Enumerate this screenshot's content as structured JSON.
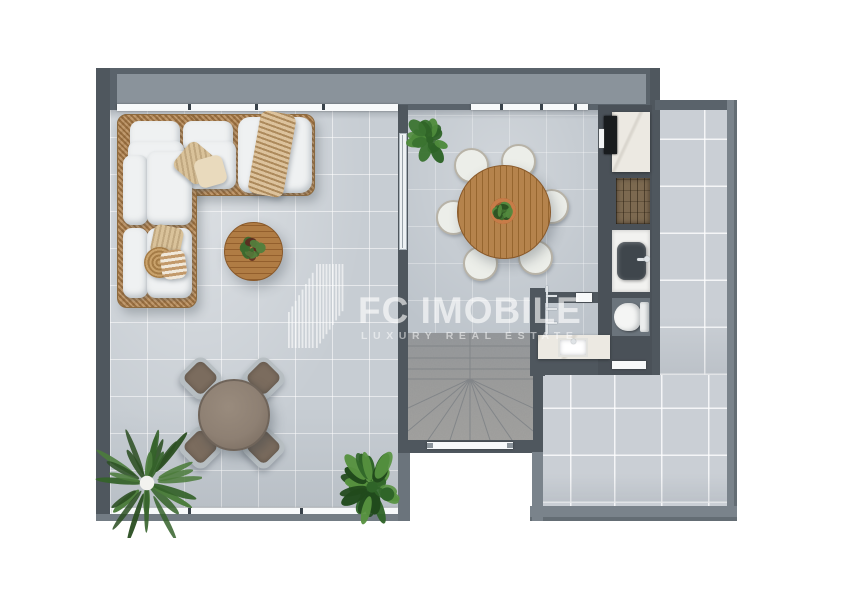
{
  "watermark": {
    "brand": "FC IMOBILE",
    "tagline": "LUXURY REAL ESTATE",
    "logo_icon": "skyline-bars-logo",
    "color": "#ffffff"
  },
  "scene": {
    "type": "top-down 3D-rendered apartment floor plan on white background",
    "palette": {
      "wall_dark": "#4f575e",
      "wall_band": "#8a939b",
      "parapet": "#7a838b",
      "terrace_floor": "#c7cdd3",
      "indoor_floor": "#bdc4cb",
      "right_terrace_floor": "#cacfd5",
      "stairs_gray": "#a4a6a7",
      "wicker_tan": "#b3885a",
      "cushion_white": "#eff1f2",
      "wood_table": "#b07c44",
      "outdoor_table_gray": "#8e8073",
      "outdoor_cushion_brown": "#7b6c5e",
      "marble_white": "#ece9e2",
      "shower_wood": "#7c6950",
      "plant_green_dark": "#2e5a26",
      "plant_green_light": "#4f8a3a"
    },
    "rooms": [
      {
        "name": "terrace-lounge",
        "items": [
          "wicker-corner-sofa",
          "white-cushions",
          "beige-pillows",
          "throw-blanket",
          "round-wood-coffee-table",
          "succulent-on-table",
          "log-pouf"
        ]
      },
      {
        "name": "terrace-outdoor-dining",
        "items": [
          "round-outdoor-table",
          "outdoor-chair x4",
          "palm-plant",
          "fern-plant"
        ]
      },
      {
        "name": "dining-room",
        "items": [
          "round-wood-dining-table",
          "white-chair x6",
          "potted-centerpiece",
          "entry-plant"
        ]
      },
      {
        "name": "kitchenette",
        "items": [
          "marble-counter",
          "black-cooktop"
        ]
      },
      {
        "name": "shower",
        "items": [
          "wood-deck-floor"
        ]
      },
      {
        "name": "washroom",
        "items": [
          "wall-hung-basin",
          "faucet"
        ]
      },
      {
        "name": "wc",
        "items": [
          "toilet",
          "door-threshold"
        ]
      },
      {
        "name": "bathroom",
        "items": [
          "marble-vanity",
          "rectangular-sink",
          "towel-rail",
          "door-threshold"
        ]
      },
      {
        "name": "staircase",
        "items": [
          "winder-stairs",
          "glass-door-threshold"
        ]
      },
      {
        "name": "terrace-right",
        "items": []
      }
    ],
    "windows": "white sill strips along top wall and bottom-left wall"
  }
}
